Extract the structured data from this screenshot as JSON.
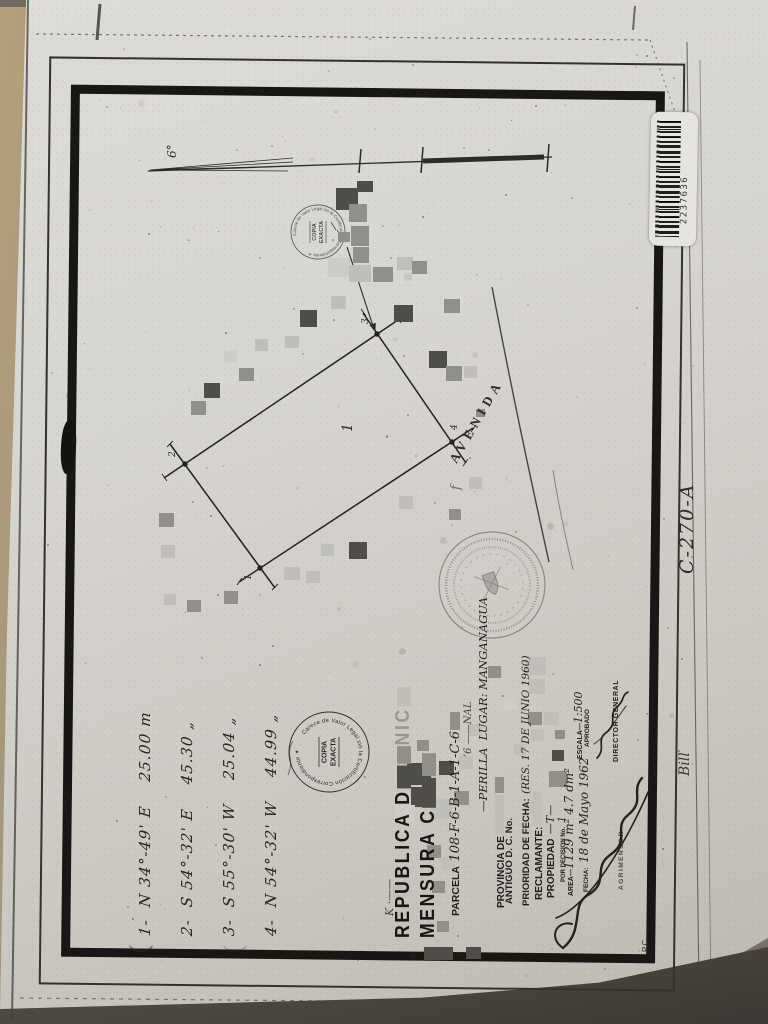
{
  "colors": {
    "paper": "#d8d6d0",
    "ink": "#1d1c1a",
    "surface_tan": "#b29c77",
    "surface_dark": "#4f4b45",
    "redaction_dark": "#4e4d49",
    "redaction_mid": "#908f8a",
    "redaction_light": "#bfbeb8",
    "redaction_xlight": "#cdccc6"
  },
  "barcode": {
    "number": "2237636"
  },
  "annotations": {
    "side_code": "C-270-A",
    "bill": "Bill",
    "pc": "P.C.",
    "k_fragment": "K ·——"
  },
  "survey": {
    "north_label": "6°",
    "avenue": "AVENIDA",
    "parcel_inner_label": "1",
    "vertices": [
      "1",
      "2",
      "3",
      "4"
    ]
  },
  "title_block": {
    "line1_visible": "REPUBLICA D",
    "line1_tail": "NIC",
    "line2_visible": "MENSURA C",
    "parcela_label": "PARCELA",
    "parcela_value": "108-F-6-B-1-A-1-C-6",
    "frag_nal": "’6 ——NAL",
    "lugar_value": "—PERILLA  LUGAR: MANGANAGUA",
    "provincia_label": "PROVINCIA DE",
    "antiguo_label": "ANTIGUO D. C. No.",
    "prioridad_label": "PRIORIDAD DE FECHA:",
    "prioridad_value": "(RES. 17 DE JUNIO 1960)",
    "reclamante_label": "RECLAMANTE:",
    "propiedad_label": "PROPIEDAD",
    "propiedad_value": "—T—",
    "decision_label": "POR DECISION No.",
    "decision_value": "1",
    "area_label": "AREA—",
    "area_value": "1129 m² 4.7 dm²",
    "fecha_label": "FECHA:",
    "fecha_value": "18 de Mayo 1962",
    "escala_label": "ESCALA—",
    "escala_value": "1:500",
    "aprobado_label": "APROBADO",
    "director_label": "DIRECTOR GENERAL",
    "agrimensor_label": "AGRIMENSOR"
  },
  "bearings": {
    "rows": [
      "1-  N 34°-49' E    25.00 m",
      "2-  S 54°-32' E    45.30 „",
      "3-  S 55°-30' W    25.04 „",
      "4-  N 54°-32' W    44.99 „"
    ]
  },
  "stamps": {
    "ring_text": "Carece de Valor Legal sin la Certificación Correspondiente ✦",
    "center_line1": "COPIA",
    "center_line2": "EXACTA"
  }
}
